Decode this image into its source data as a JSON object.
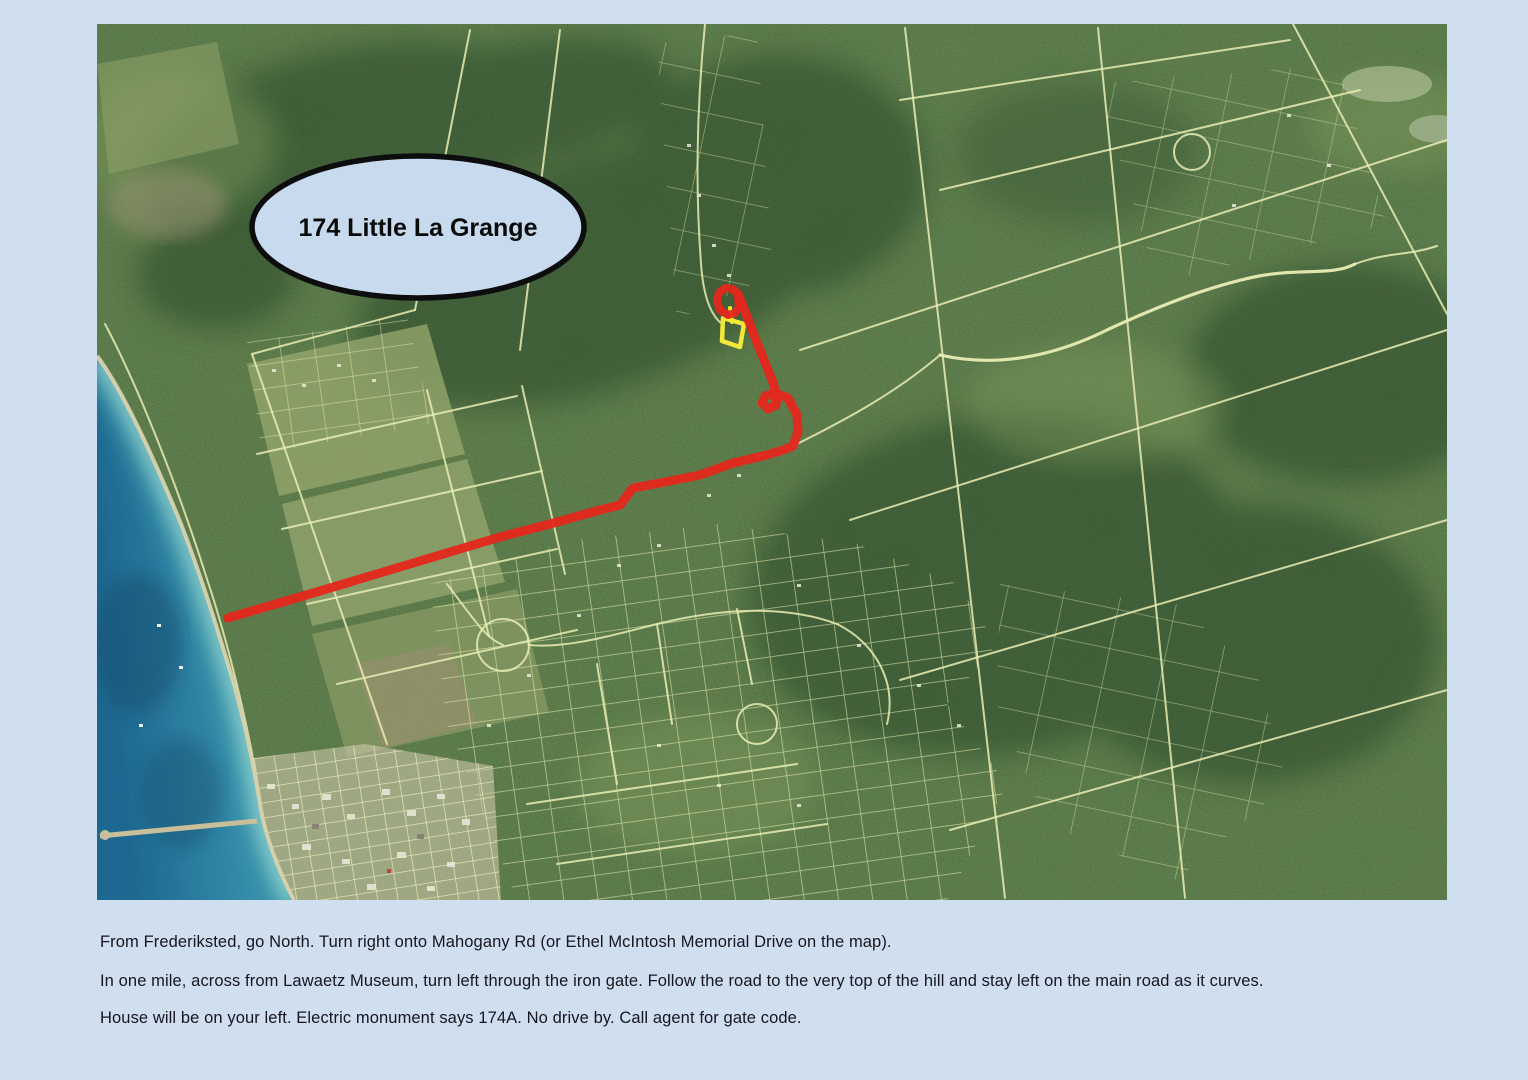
{
  "page": {
    "background": "#cfdff0"
  },
  "map": {
    "palette": {
      "page-bg": "#cfdff0",
      "land": "#57743f",
      "forest": "#2c4a2b",
      "field": "#93a56c",
      "field-brown": "#988f6e",
      "parcel-line": "#e9edb4",
      "sand": "#d8d2ae",
      "water-deep": "#1d6890",
      "water-shallow": "#8fd4cd",
      "town": "#cbc6a9",
      "route": "#e5271c",
      "highlight": "#f2e838",
      "callout-fill": "#c8daee",
      "callout-border": "#0d0d0d"
    },
    "callout": {
      "text": "174 Little La Grange",
      "cx": 321,
      "cy": 203,
      "rx": 166,
      "ry": 71
    },
    "route": {
      "width": 9,
      "points": [
        [
          131,
          594
        ],
        [
          213,
          570
        ],
        [
          303,
          543
        ],
        [
          403,
          513
        ],
        [
          453,
          500
        ],
        [
          503,
          486
        ],
        [
          523,
          481
        ],
        [
          536,
          464
        ],
        [
          563,
          459
        ],
        [
          603,
          451
        ],
        [
          636,
          439
        ],
        [
          670,
          431
        ],
        [
          686,
          426
        ],
        [
          696,
          422
        ],
        [
          701,
          408
        ],
        [
          700,
          391
        ],
        [
          691,
          374
        ],
        [
          678,
          369
        ],
        [
          668,
          372
        ],
        [
          665,
          379
        ],
        [
          671,
          385
        ],
        [
          679,
          381
        ],
        [
          680,
          371
        ],
        [
          675,
          356
        ],
        [
          667,
          336
        ],
        [
          657,
          311
        ],
        [
          649,
          290
        ],
        [
          644,
          277
        ],
        [
          641,
          270
        ]
      ],
      "loop": [
        [
          641,
          270
        ],
        [
          636,
          265
        ],
        [
          628,
          264
        ],
        [
          622,
          269
        ],
        [
          620,
          277
        ],
        [
          623,
          286
        ],
        [
          631,
          291
        ],
        [
          638,
          289
        ],
        [
          642,
          282
        ],
        [
          641,
          273
        ]
      ]
    },
    "highlight_parcel": {
      "points": [
        [
          626,
          294
        ],
        [
          647,
          300
        ],
        [
          643,
          323
        ],
        [
          625,
          317
        ]
      ],
      "stem": [
        [
          633,
          284
        ],
        [
          635,
          298
        ]
      ]
    }
  },
  "directions": {
    "color": "#16161e",
    "lines": [
      "From Frederiksted, go North. Turn right onto Mahogany Rd (or Ethel McIntosh Memorial Drive on the map).",
      "In one mile, across from Lawaetz Museum, turn left through the iron gate. Follow the road to the very top of the hill and stay left on the main road as it curves.",
      "House will be on your left.  Electric monument says 174A. No drive by. Call agent for gate code."
    ]
  }
}
